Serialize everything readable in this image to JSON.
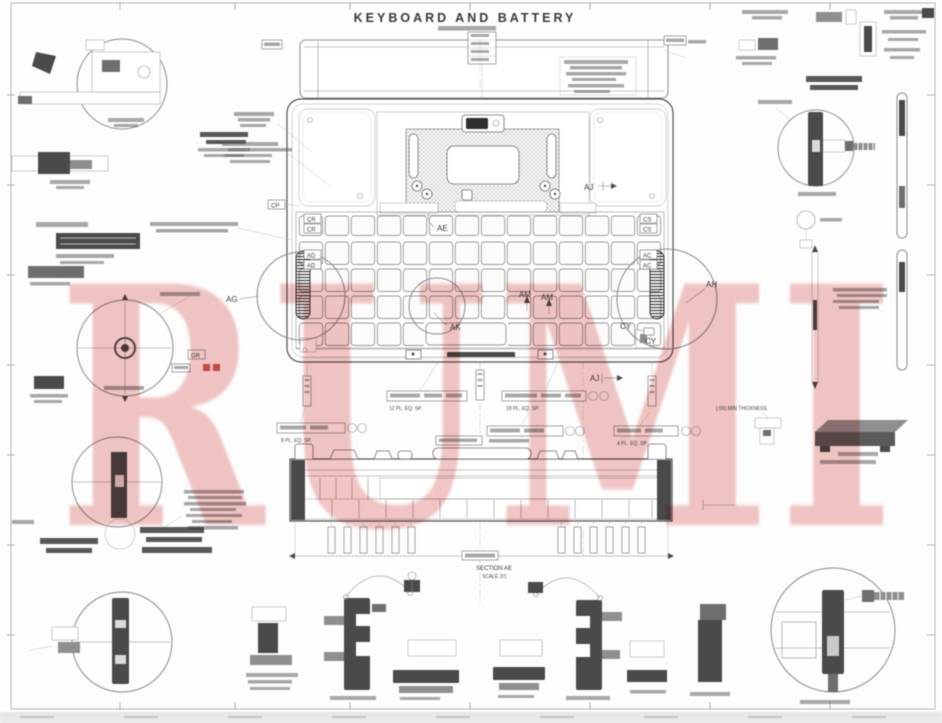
{
  "drawing": {
    "title": "KEYBOARD AND BATTERY",
    "watermark": "RUMI",
    "callouts": {
      "ae": "AE",
      "aj": "AJ",
      "ad": "AD",
      "ac": "AC",
      "ag": "AG",
      "ah": "AH",
      "ak": "AK",
      "am": "AM",
      "cy": "CY",
      "cr": "CR",
      "cs": "CS",
      "cp": "CP",
      "gr": "GR"
    },
    "notes": {
      "eq12": "12 PL. EQ. SP.",
      "eq18": "18 PL. EQ. SP.",
      "eq8": "8 PL. EQ. SP.",
      "eq4": "4 PL. EQ. SP.",
      "thickness": "(.06) MIN THICKNESS",
      "section": "SECTION AE",
      "scale": "SCALE 2/1"
    },
    "colors": {
      "watermark": "#cd3e39",
      "line": "#5a5a5a",
      "dark_fill": "#4a4a4a"
    }
  }
}
